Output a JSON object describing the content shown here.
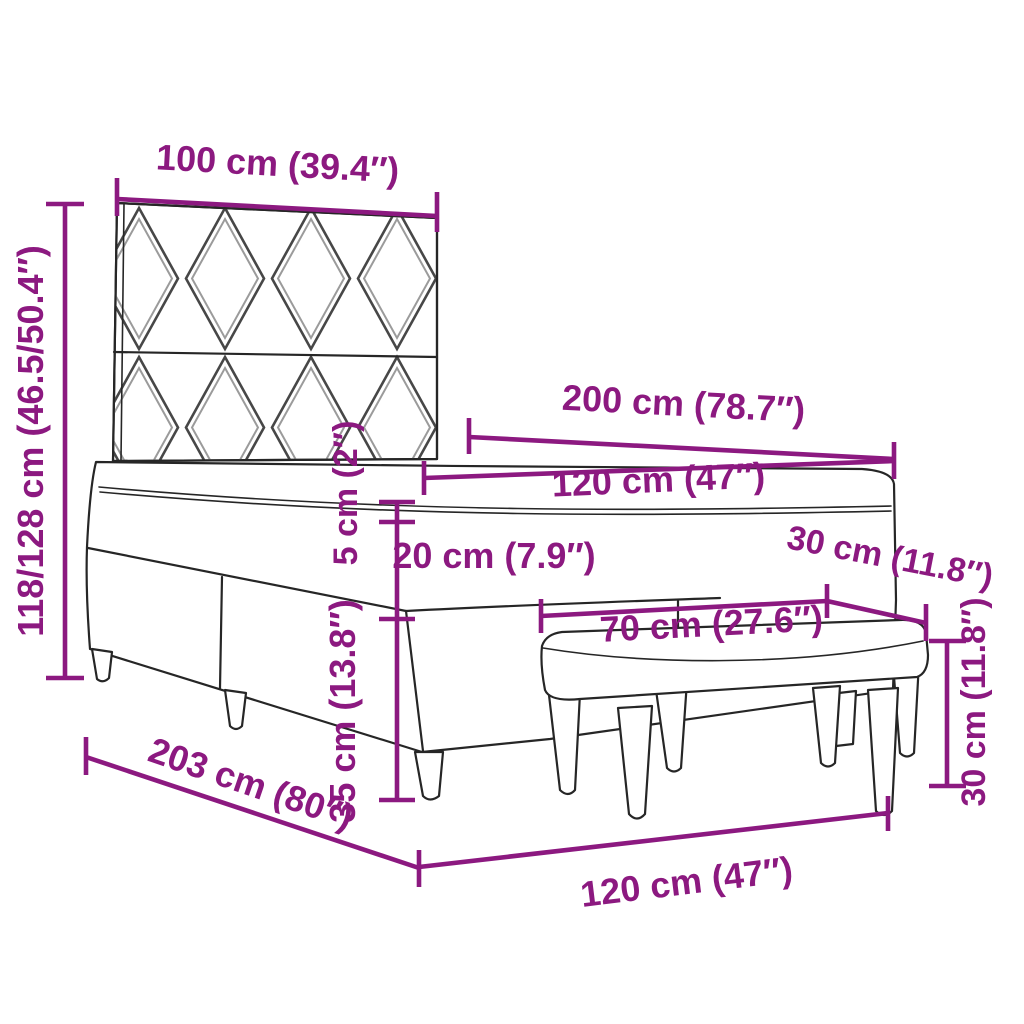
{
  "diagram": {
    "type": "furniture-dimension-diagram",
    "subject": "box spring bed with headboard, mattress topper and bench",
    "units": "cm and inches"
  },
  "colors": {
    "dimension": "#8C1980",
    "line": "#262626",
    "pattern-dark": "#474747",
    "pattern-light": "#9b9b9b",
    "bg": "#ffffff"
  },
  "dimensions": {
    "headboard_width": "100 cm (39.4″)",
    "total_height": "118/128 cm (46.5/50.4″)",
    "mattress_length": "200 cm (78.7″)",
    "mattress_width": "120 cm (47″)",
    "topper_height": "5 cm (2″)",
    "mattress_height": "20 cm (7.9″)",
    "base_height": "35 cm (13.8″)",
    "bench_depth": "30 cm (11.8″)",
    "bench_length": "70 cm (27.6″)",
    "bench_height": "30 cm (11.8″)",
    "bed_length": "203 cm (80″)",
    "bed_width": "120 cm (47″)"
  }
}
